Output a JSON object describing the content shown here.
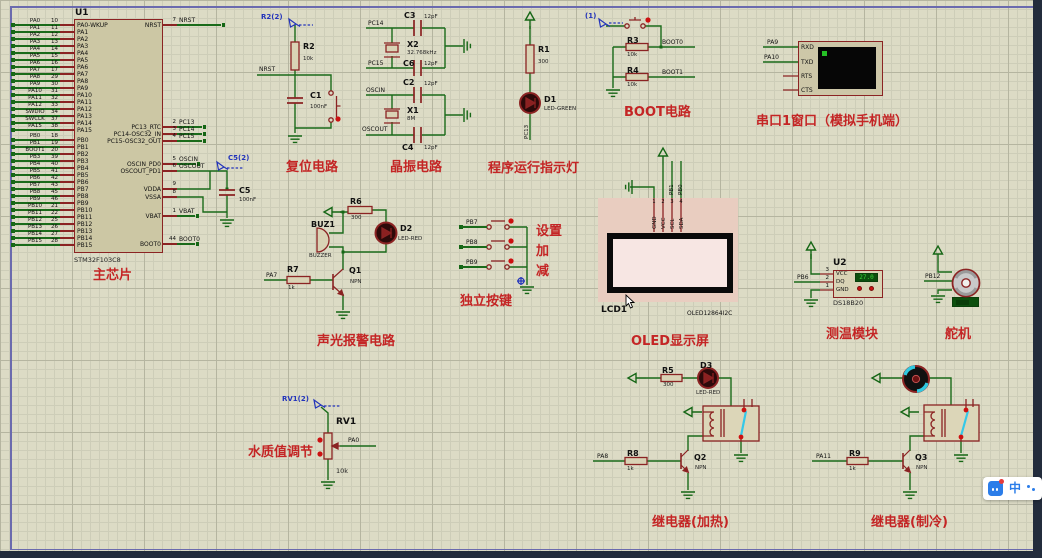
{
  "app": {
    "ime_char": "中"
  },
  "chip": {
    "ref": "U1",
    "part": "STM32F103C8",
    "caption": "主芯片",
    "left_pa": {
      "nets": [
        "PA0",
        "PA1",
        "PA2",
        "PA3",
        "PA4",
        "PA5",
        "PA6",
        "PA7",
        "PA8",
        "PA9",
        "PA10",
        "PA11",
        "PA12",
        "SWDIO",
        "SWCLK",
        "PA15"
      ],
      "nums": [
        "10",
        "11",
        "12",
        "13",
        "14",
        "15",
        "16",
        "17",
        "29",
        "30",
        "31",
        "32",
        "33",
        "34",
        "37",
        "38"
      ],
      "names": [
        "PA0-WKUP",
        "PA1",
        "PA2",
        "PA3",
        "PA4",
        "PA5",
        "PA6",
        "PA7",
        "PA8",
        "PA9",
        "PA10",
        "PA11",
        "PA12",
        "PA13",
        "PA14",
        "PA15"
      ]
    },
    "left_pb": {
      "nets": [
        "PB0",
        "PB1",
        "BOOT1",
        "PB3",
        "PB4",
        "PB5",
        "PB6",
        "PB7",
        "PB8",
        "PB9",
        "PB10",
        "PB11",
        "PB12",
        "PB13",
        "PB14",
        "PB15"
      ],
      "nums": [
        "18",
        "19",
        "20",
        "39",
        "40",
        "41",
        "42",
        "43",
        "45",
        "46",
        "21",
        "22",
        "25",
        "26",
        "27",
        "28"
      ],
      "names": [
        "PB0",
        "PB1",
        "PB2",
        "PB3",
        "PB4",
        "PB5",
        "PB6",
        "PB7",
        "PB8",
        "PB9",
        "PB10",
        "PB11",
        "PB12",
        "PB13",
        "PB14",
        "PB15"
      ]
    },
    "right": {
      "names": [
        "NRST",
        "PC13_RTC",
        "PC14-OSC32_IN",
        "PC15-OSC32_OUT",
        "OSCIN_PD0",
        "OSCOUT_PD1",
        "VDDA",
        "VSSA",
        "VBAT",
        "BOOT0"
      ],
      "nums": [
        "7",
        "2",
        "3",
        "4",
        "5",
        "6",
        "9",
        "8",
        "1",
        "44"
      ],
      "nets": [
        "NRST",
        "PC13",
        "PC14",
        "PC15",
        "OSCIN",
        "OSCOUT",
        "",
        "",
        "VBAT",
        "BOOT0"
      ]
    },
    "c5_ref": "C5",
    "c5_val": "100nF",
    "c5_probe": "C5(2)"
  },
  "reset": {
    "title": "复位电路",
    "probe": "R2(2)",
    "r_ref": "R2",
    "r_val": "10k",
    "net": "NRST",
    "c_ref": "C1",
    "c_val": "100nF"
  },
  "crystal": {
    "title": "晶振电路",
    "net_pc14": "PC14",
    "net_pc15": "PC15",
    "net_oscin": "OSCIN",
    "net_oscout": "OSCOUT",
    "c3_ref": "C3",
    "c3_val": "12pF",
    "c6_ref": "C6",
    "c6_val": "12pF",
    "c2_ref": "C2",
    "c2_val": "12pF",
    "c4_ref": "C4",
    "c4_val": "12pF",
    "x2_ref": "X2",
    "x2_val": "32.768kHz",
    "x1_ref": "X1",
    "x1_val": "8M"
  },
  "indicator": {
    "title": "程序运行指示灯",
    "r_ref": "R1",
    "r_val": "300",
    "d_ref": "D1",
    "d_val": "LED-GREEN",
    "net": "PC13"
  },
  "boot": {
    "title": "BOOT电路",
    "probe": "(1)",
    "r3_ref": "R3",
    "r3_val": "10k",
    "r4_ref": "R4",
    "r4_val": "10k",
    "net0": "BOOT0",
    "net1": "BOOT1"
  },
  "serial": {
    "title": "串口1窗口（模拟手机端）",
    "pins": [
      "RXD",
      "TXD",
      "RTS",
      "CTS"
    ],
    "net_rx": "PA9",
    "net_tx": "PA10"
  },
  "alarm": {
    "title": "声光报警电路",
    "r6_ref": "R6",
    "r6_val": "300",
    "buz_ref": "BUZ1",
    "buz_val": "BUZZER",
    "d2_ref": "D2",
    "d2_val": "LED-RED",
    "q1_ref": "Q1",
    "q1_val": "NPN",
    "r7_ref": "R7",
    "r7_val": "1k",
    "net": "PA7"
  },
  "keys": {
    "title": "独立按键",
    "rows": [
      {
        "net": "PB7",
        "label": "设置"
      },
      {
        "net": "PB8",
        "label": "加"
      },
      {
        "net": "PB9",
        "label": "减"
      }
    ]
  },
  "oled": {
    "title": "OLED显示屏",
    "ref": "LCD1",
    "part": "OLED12864I2C",
    "pins": [
      "GND",
      "VCC",
      "SCL",
      "SDA"
    ],
    "nums": [
      "1",
      "2",
      "3",
      "4"
    ],
    "net_scl": "PB1",
    "net_sda": "PB0"
  },
  "temp": {
    "title": "测温模块",
    "ref": "U2",
    "part": "DS18B20",
    "pins": [
      "VCC",
      "DQ",
      "GND"
    ],
    "nums": [
      "3",
      "2",
      "1"
    ],
    "net": "PB6",
    "reading": "27.0"
  },
  "servo": {
    "title": "舵机",
    "net": "PB12"
  },
  "water": {
    "title": "水质值调节",
    "probe": "RV1(2)",
    "ref": "RV1",
    "val": "10k",
    "net": "PA0"
  },
  "relay_heat": {
    "title": "继电器(加热)",
    "r5_ref": "R5",
    "r5_val": "300",
    "d3_ref": "D3",
    "d3_val": "LED-RED",
    "q2_ref": "Q2",
    "q2_val": "NPN",
    "r8_ref": "R8",
    "r8_val": "1k",
    "net": "PA8"
  },
  "relay_cool": {
    "title": "继电器(制冷)",
    "q3_ref": "Q3",
    "q3_val": "NPN",
    "r9_ref": "R9",
    "r9_val": "1k",
    "net": "PA11"
  }
}
